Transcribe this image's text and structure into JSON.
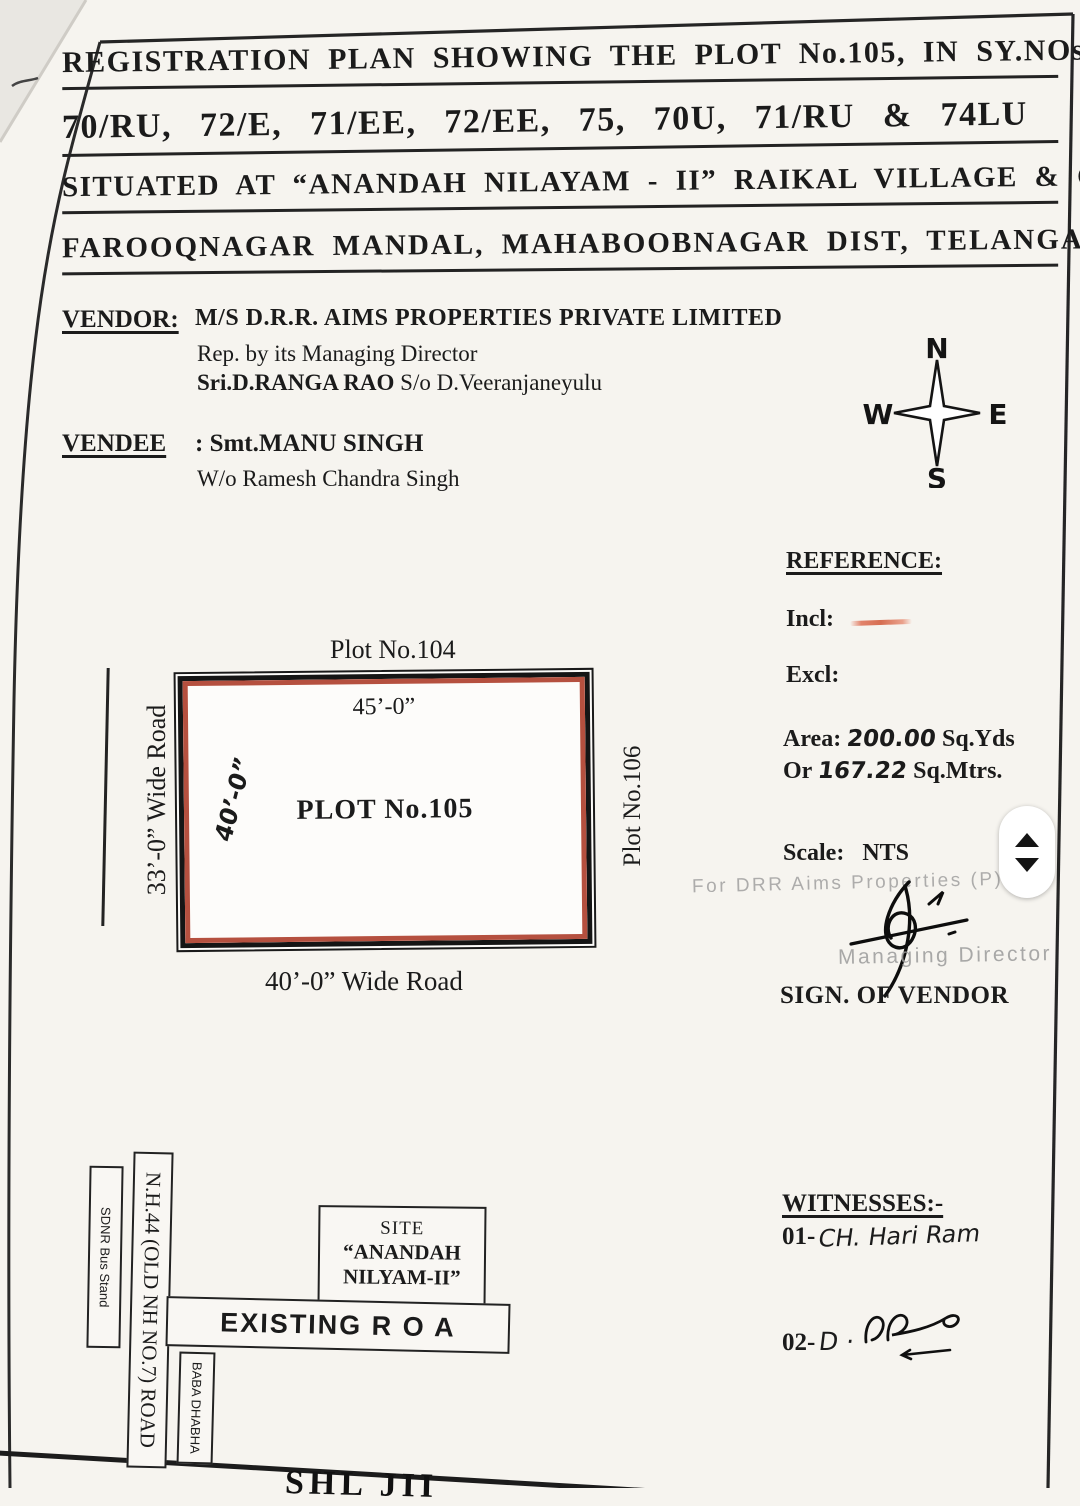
{
  "title": {
    "lines": [
      "REGISTRATION PLAN SHOWING THE PLOT No.105, IN SY.NOs.",
      "70/RU, 72/E, 71/EE, 72/EE, 75, 70U,  71/RU & 74LU",
      "SITUATED AT “ANANDAH NILAYAM - II” RAIKAL VILLAGE & G.P.,",
      "FAROOQNAGAR MANDAL, MAHABOOBNAGAR DIST, TELANGANA."
    ]
  },
  "vendor": {
    "label": "VENDOR:",
    "company": "M/S D.R.R. AIMS PROPERTIES PRIVATE LIMITED",
    "rep_line": "Rep. by its Managing Director",
    "principal_bold": "Sri.D.RANGA RAO",
    "principal_rest": " S/o D.Veeranjaneyulu"
  },
  "vendee": {
    "label": "VENDEE",
    "name_line": ": Smt.MANU SINGH",
    "relation_line": "W/o Ramesh Chandra Singh"
  },
  "compass": {
    "north": "N",
    "south": "S",
    "east": "E",
    "west": "W"
  },
  "reference": {
    "heading": "REFERENCE:",
    "incl_label": "Incl:",
    "excl_label": "Excl:",
    "area_label": "Area:",
    "area_value": "200.00",
    "area_unit": "Sq.Yds",
    "or_label": "Or",
    "area_m_value": "167.22",
    "area_m_unit": "Sq.Mtrs.",
    "scale_label": "Scale:",
    "scale_value": "NTS"
  },
  "plan": {
    "plot_above": "Plot No.104",
    "dim_top": "45’-0”",
    "plot_label": "PLOT No.105",
    "dim_left": "40’-0”",
    "plot_right": "Plot No.106",
    "road_left": "33’-0” Wide Road",
    "road_bottom": "40’-0” Wide Road"
  },
  "vendor_sign": {
    "stamp_line": "For DRR Aims Properties (P) Ltd.",
    "stamp_role": "Managing Director",
    "caption": "SIGN. OF VENDOR"
  },
  "witnesses": {
    "heading": "WITNESSES:-",
    "first_no": "01-",
    "first_name": "CH. Hari Ram",
    "second_no": "02-",
    "second_name": "D ·"
  },
  "site_map": {
    "bus_stand": "SDNR Bus Stand",
    "highway": "N.H.44 (OLD NH NO.7) ROAD",
    "site_line1": "SITE",
    "site_line2": "“ANANDAH",
    "site_line3": "NILYAM-II”",
    "existing_road": "EXISTING R O A",
    "dhabha": "BABA DHABHA"
  },
  "bottom_fragment": "SHL JII",
  "colors": {
    "ink": "#1b1b1b",
    "plot-red": "#b5503f",
    "incl-mark": "#e2836b",
    "stamp-gray": "#9b9b9b",
    "paper": "#f6f4ef"
  }
}
